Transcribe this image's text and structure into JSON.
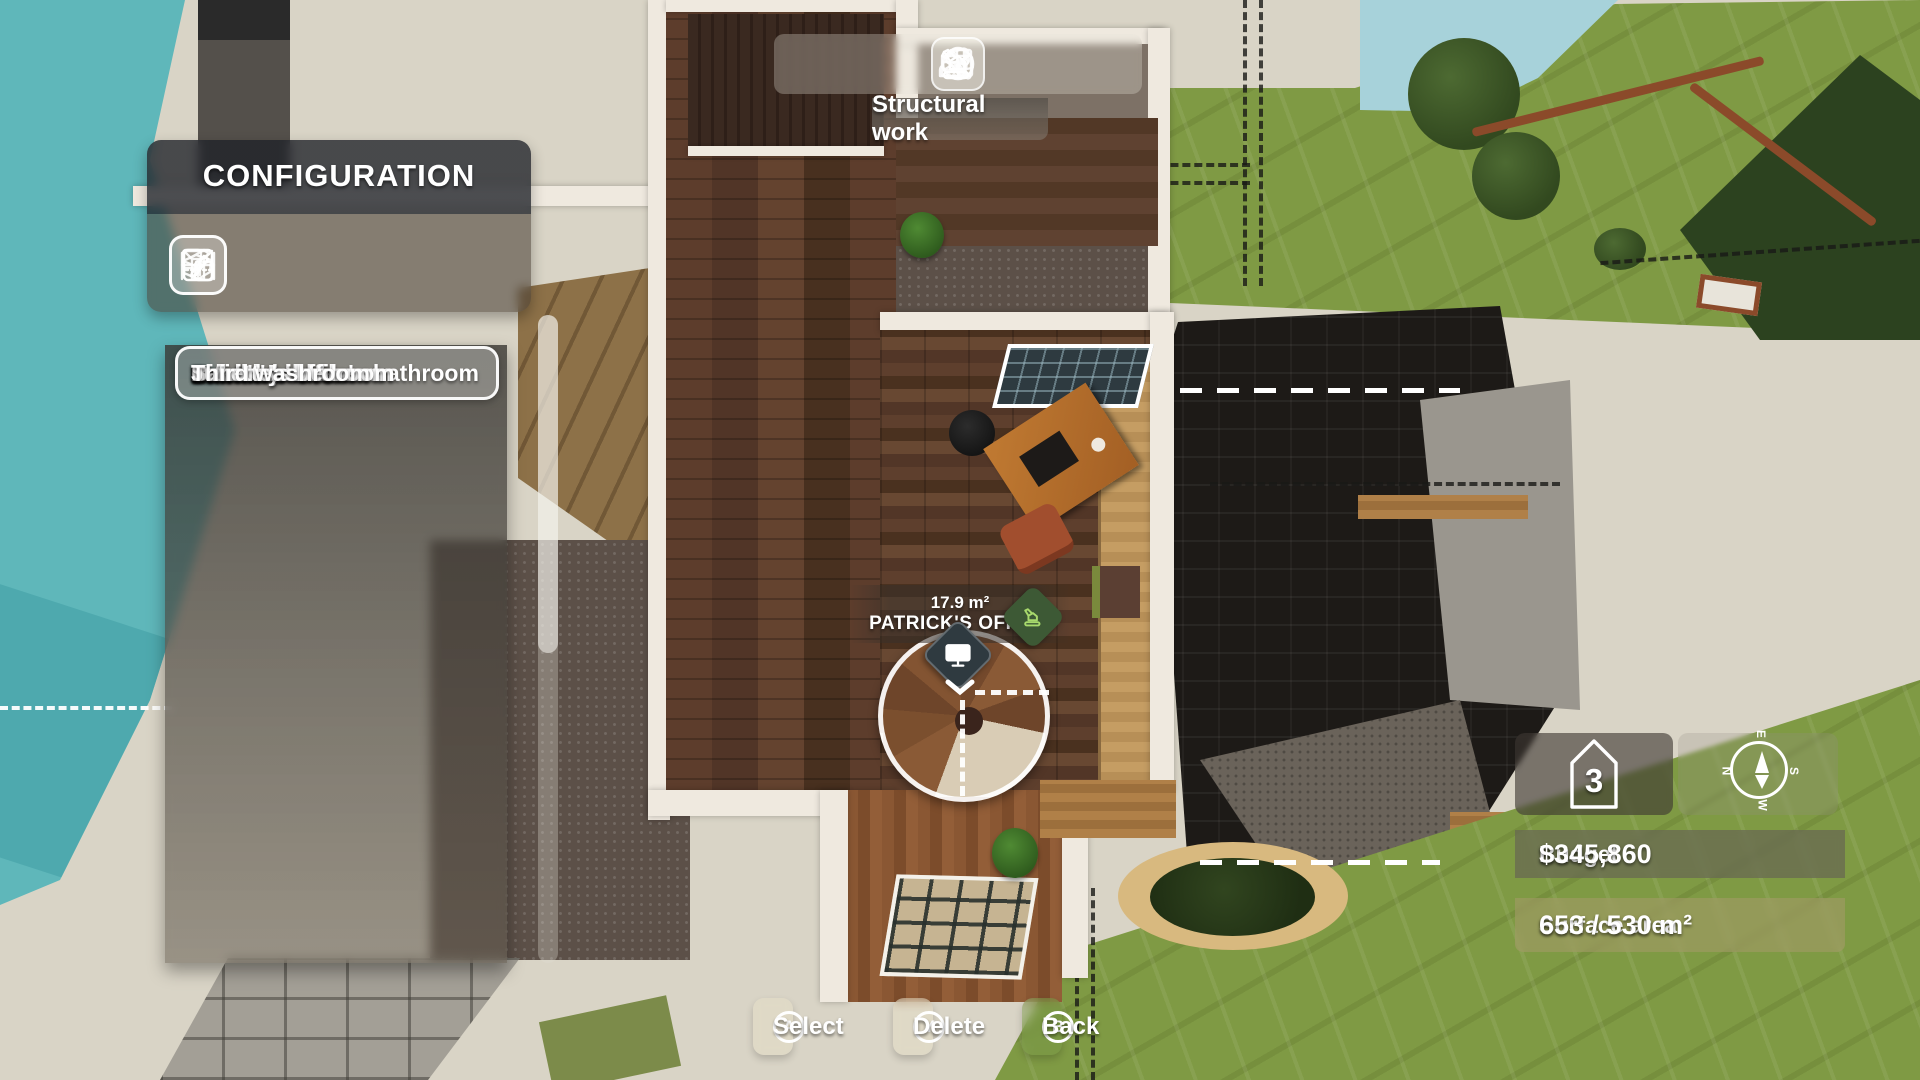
{
  "toolbar": {
    "tooltip": "Structural work",
    "tools": [
      {
        "icon": "excavator-icon",
        "selected": true
      },
      {
        "icon": "paint-roller-icon",
        "selected": false
      },
      {
        "icon": "tree-icon",
        "selected": false
      },
      {
        "icon": "furniture-icon",
        "selected": false
      },
      {
        "icon": "picture-frame-icon",
        "selected": false
      },
      {
        "icon": "checkmark-icon",
        "selected": false
      }
    ]
  },
  "config": {
    "title": "CONFIGURATION",
    "tools": [
      {
        "icon": "pencil-edit-icon",
        "selected": true
      },
      {
        "icon": "materials-box-icon",
        "selected": false
      },
      {
        "icon": "duplicate-room-icon",
        "selected": false
      },
      {
        "icon": "foundation-icon",
        "selected": false
      },
      {
        "icon": "demolish-icon",
        "selected": false
      }
    ],
    "rooms": [
      "Kitchen",
      "Laundry room",
      "Emma's bedroom",
      "Erick's bedroom",
      "Grandchildren's bathroom",
      "Patrick's office",
      "Sandra's office",
      "Balcony",
      "Sandra's bedroom",
      "Juliette's bedroom",
      "Third washroom"
    ],
    "selected_room": "Patrick's office"
  },
  "room_label": {
    "area": "17.9 m²",
    "name": "PATRICK'S OFFICE"
  },
  "info": {
    "floor": "3",
    "compass": {
      "n": "N",
      "e": "E",
      "s": "S",
      "w": "W"
    },
    "budget_label": "Budget",
    "budget_value": "$345,860",
    "surface_label": "Surface area",
    "surface_value": "653 / 530 m²"
  },
  "actions": [
    {
      "key": "A",
      "label": "Select"
    },
    {
      "key": "Y",
      "label": "Delete"
    },
    {
      "key": "B",
      "label": "Back"
    }
  ],
  "colors": {
    "water_left": "#5fb7ba",
    "water_top_right": "#a7d2da",
    "grass": "#7f9a44",
    "sand": "#e7cb90",
    "plaster": "#d9d4c6",
    "black_roof": "#1d1a17",
    "wood_floor": "#5d3d2c",
    "wall_white": "#efe9df",
    "tent_green": "#2c421f",
    "marker_green": "#3d5935",
    "marker_dark": "#2f3a40"
  }
}
